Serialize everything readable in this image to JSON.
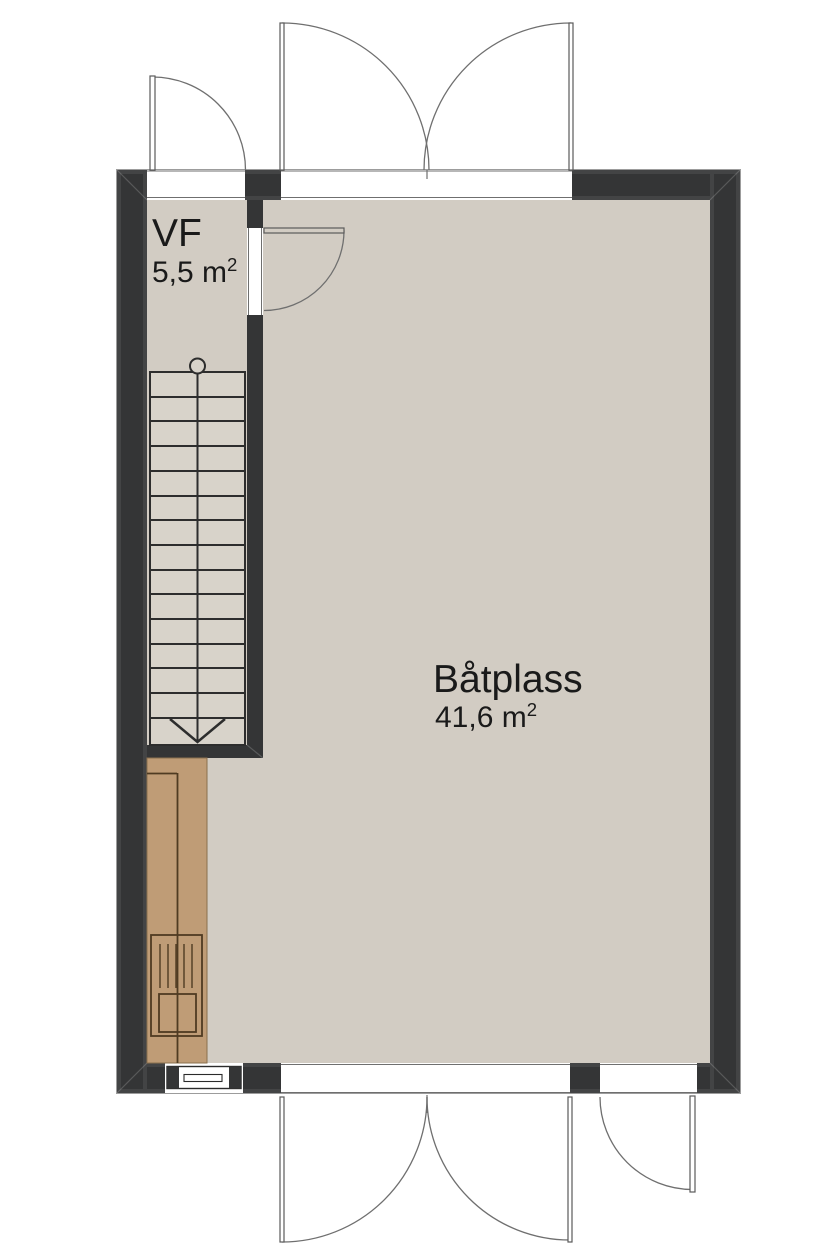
{
  "plan": {
    "rooms": [
      {
        "name": "VF",
        "area": "5,5 m",
        "area_sup": "2"
      },
      {
        "name": "Båtplass",
        "area": "41,6 m",
        "area_sup": "2"
      }
    ],
    "symbols": [
      "staircase-with-direction-arrow",
      "exterior-single-door-top-left",
      "exterior-double-door-top",
      "interior-door-vf",
      "window-bottom-left",
      "exterior-double-door-bottom",
      "exterior-single-door-bottom-right",
      "kitchen-counter-with-sink"
    ]
  },
  "colors": {
    "background": "#ffffff",
    "floor": "#d2ccc3",
    "stair-floor": "#d8d3ca",
    "wall": "#343536",
    "counter": "#bf9c76",
    "counter-line": "#4f3b22",
    "line": "#2d2d2d",
    "door-line": "#6f6f6f",
    "text": "#1a1a1a"
  }
}
